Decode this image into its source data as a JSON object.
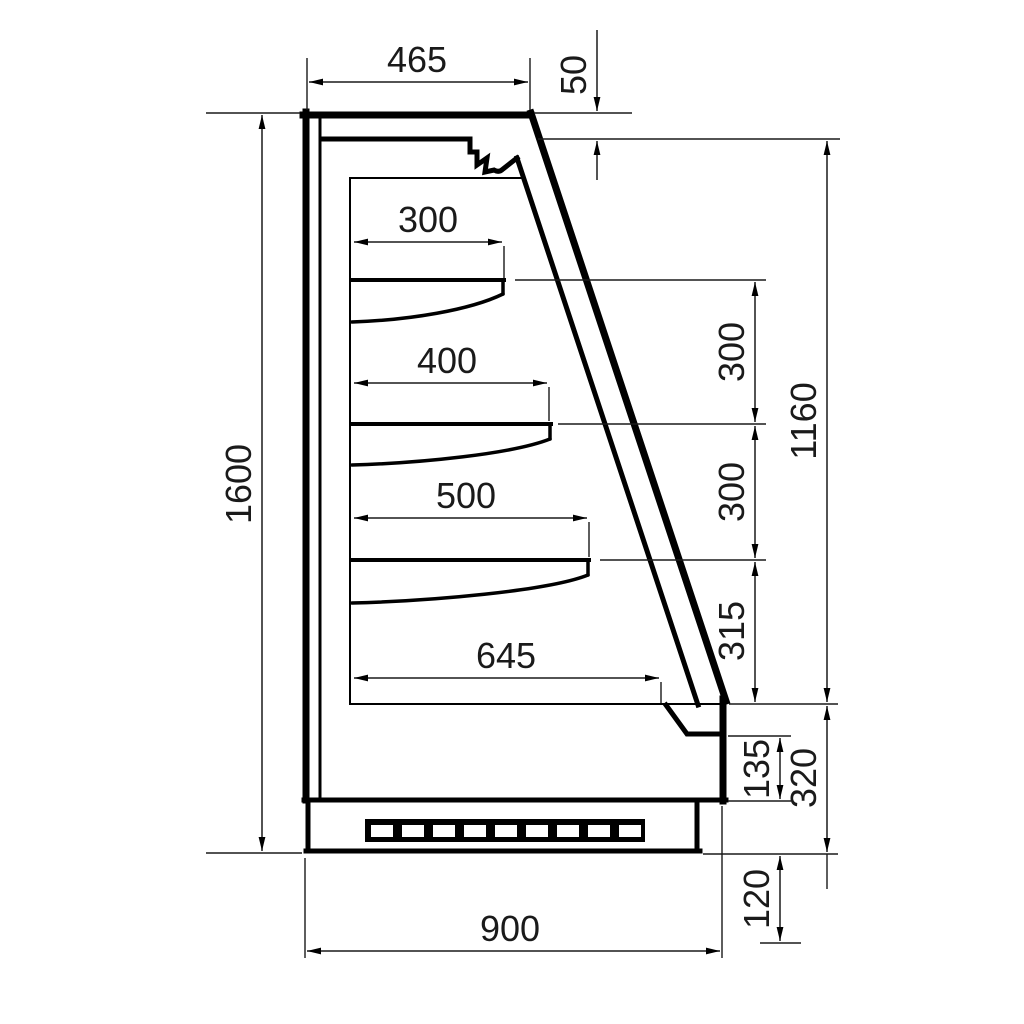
{
  "diagram": {
    "type": "technical-drawing",
    "subject": "refrigerated-display-cabinet-cross-section",
    "unit": "mm",
    "background": "#ffffff",
    "line_color": "#000000",
    "dimensions": {
      "top_depth": "465",
      "canopy_offset": "50",
      "shelf_1_depth": "300",
      "shelf_2_depth": "400",
      "shelf_3_depth": "500",
      "base_shelf_depth": "645",
      "overall_height": "1600",
      "shelf_gap_1": "300",
      "shelf_gap_2": "300",
      "shelf_gap_3": "315",
      "opening_height": "1160",
      "sill_height": "135",
      "base_height": "320",
      "plinth_height": "120",
      "overall_depth": "900"
    }
  }
}
